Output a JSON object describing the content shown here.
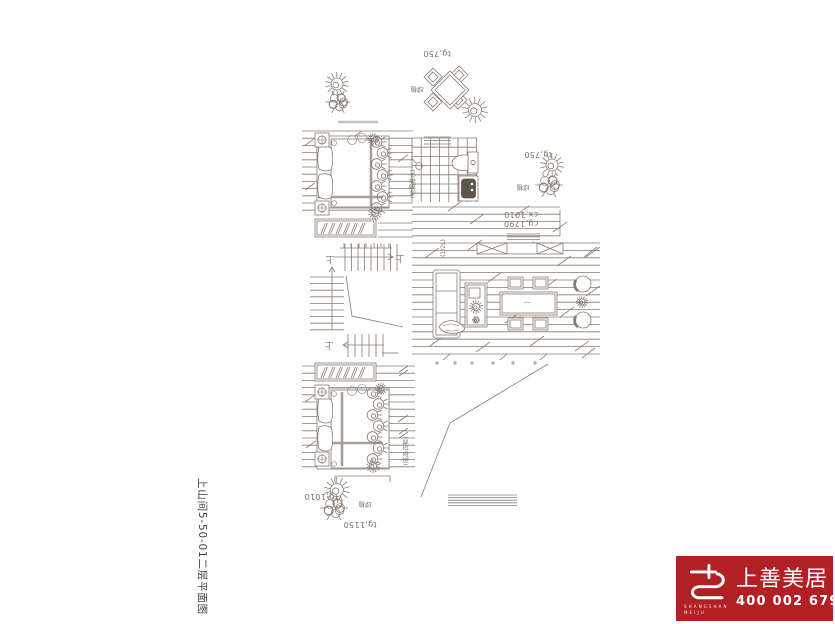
{
  "title": {
    "text": "上山间5-50-01二层平面图"
  },
  "plan": {
    "line_color": "#877c72",
    "labels": {
      "roof_sill": "tg,750",
      "roof_plant": "绿植",
      "terrace_sill": "tg,750",
      "terrace_plant": "绿植",
      "window_height": "cg,1790",
      "window_width": "cx,1010",
      "stair_up_right": "上",
      "stair_up_left": "上",
      "stair_up_bottom": "上",
      "bath_note": "(地漏排水)",
      "mirror_note": "(1/2L)",
      "wardrobe_note": "(成品衣柜)",
      "lower_sill_a": "tg,1010",
      "lower_plant": "绿植",
      "lower_sill_b": "tg,1150"
    }
  },
  "logo": {
    "brand": "上善美居",
    "brand_en_line1": "SHANGSHAN",
    "brand_en_line2": "MEIJU",
    "phone": "400 002 6791",
    "red": "#b02025"
  }
}
